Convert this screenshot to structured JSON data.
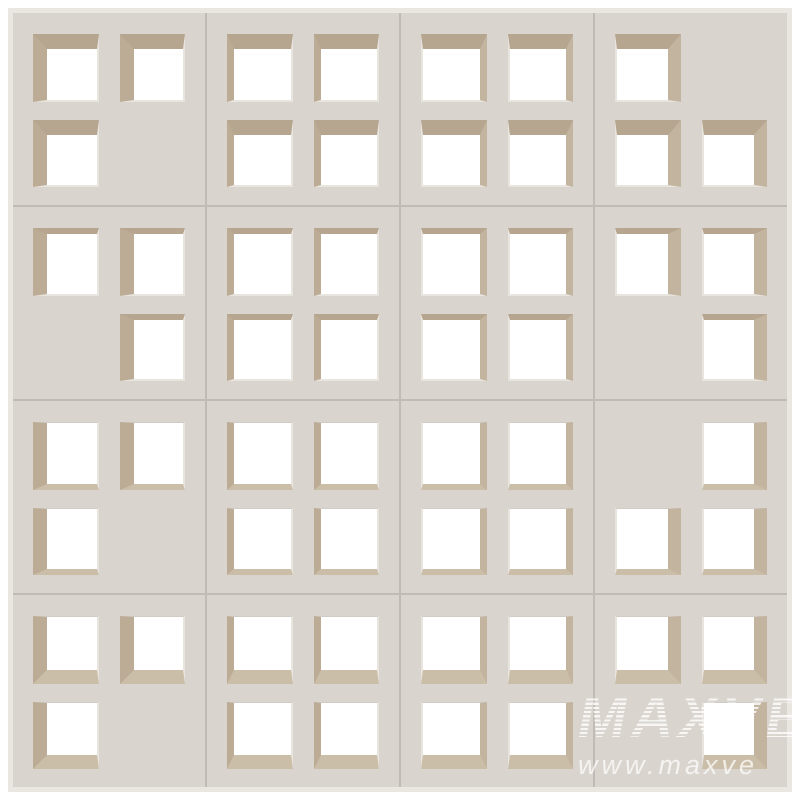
{
  "watermark": {
    "brand": "MAXVE",
    "url": "www.maxve"
  },
  "colors": {
    "background": "#ffffff",
    "block_face": "#d9d4ce",
    "seam": "#c0bbb5",
    "outer_edge": "#eae7e3",
    "hole": "#ffffff",
    "reveal_top": "#b6a58f",
    "reveal_bottom": "#cbbea9",
    "reveal_left": "#bcac96",
    "reveal_right": "#c2b49f",
    "chamfer_light": "#e8e4de",
    "chamfer_dark": "#d0cbc5"
  },
  "wall": {
    "rows": 4,
    "cols": 4,
    "geometry": {
      "row_reveals": [
        {
          "side": "top",
          "px": 15
        },
        {
          "side": "top",
          "px": 6
        },
        {
          "side": "bottom",
          "px": 6
        },
        {
          "side": "bottom",
          "px": 14
        }
      ],
      "col_reveals": [
        {
          "side": "left",
          "px": 14
        },
        {
          "side": "left",
          "px": 7
        },
        {
          "side": "right",
          "px": 7
        },
        {
          "side": "right",
          "px": 13
        }
      ],
      "chamfer_px": 2,
      "chamfer_top_px": 1
    },
    "blocks": [
      {
        "row": 0,
        "col": 0,
        "holes": [
          true,
          true,
          true,
          false
        ]
      },
      {
        "row": 0,
        "col": 1,
        "holes": [
          true,
          true,
          true,
          true
        ]
      },
      {
        "row": 0,
        "col": 2,
        "holes": [
          true,
          true,
          true,
          true
        ]
      },
      {
        "row": 0,
        "col": 3,
        "holes": [
          true,
          false,
          true,
          true
        ]
      },
      {
        "row": 1,
        "col": 0,
        "holes": [
          true,
          true,
          false,
          true
        ]
      },
      {
        "row": 1,
        "col": 1,
        "holes": [
          true,
          true,
          true,
          true
        ]
      },
      {
        "row": 1,
        "col": 2,
        "holes": [
          true,
          true,
          true,
          true
        ]
      },
      {
        "row": 1,
        "col": 3,
        "holes": [
          true,
          true,
          false,
          true
        ]
      },
      {
        "row": 2,
        "col": 0,
        "holes": [
          true,
          true,
          true,
          false
        ]
      },
      {
        "row": 2,
        "col": 1,
        "holes": [
          true,
          true,
          true,
          true
        ]
      },
      {
        "row": 2,
        "col": 2,
        "holes": [
          true,
          true,
          true,
          true
        ]
      },
      {
        "row": 2,
        "col": 3,
        "holes": [
          false,
          true,
          true,
          true
        ]
      },
      {
        "row": 3,
        "col": 0,
        "holes": [
          true,
          true,
          true,
          false
        ]
      },
      {
        "row": 3,
        "col": 1,
        "holes": [
          true,
          true,
          true,
          true
        ]
      },
      {
        "row": 3,
        "col": 2,
        "holes": [
          true,
          true,
          true,
          true
        ]
      },
      {
        "row": 3,
        "col": 3,
        "holes": [
          true,
          true,
          false,
          true
        ]
      }
    ]
  }
}
